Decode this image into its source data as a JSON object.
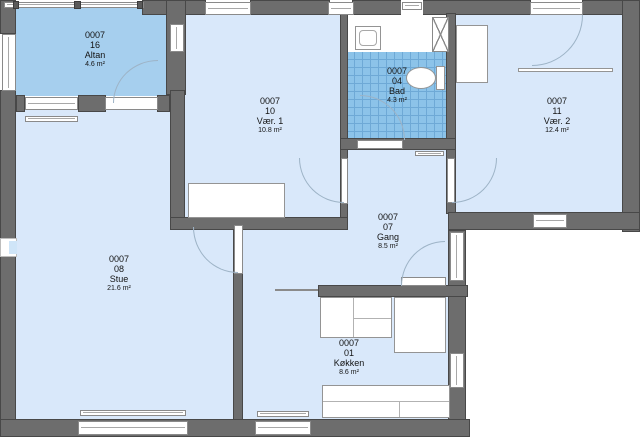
{
  "plan": {
    "type": "apartment-floor-plan",
    "unit_code": "0007",
    "rooms": {
      "altan": {
        "code": "0007",
        "number": "16",
        "name": "Altan",
        "area": "4.6 m²"
      },
      "vaer1": {
        "code": "0007",
        "number": "10",
        "name": "Vær. 1",
        "area": "10.8 m²"
      },
      "bad": {
        "code": "0007",
        "number": "04",
        "name": "Bad",
        "area": "4.3 m²"
      },
      "vaer2": {
        "code": "0007",
        "number": "11",
        "name": "Vær. 2",
        "area": "12.4 m²"
      },
      "gang": {
        "code": "0007",
        "number": "07",
        "name": "Gang",
        "area": "8.5 m²"
      },
      "stue": {
        "code": "0007",
        "number": "08",
        "name": "Stue",
        "area": "21.6 m²"
      },
      "koekken": {
        "code": "0007",
        "number": "01",
        "name": "Køkken",
        "area": "8.6 m²"
      }
    },
    "fixtures": [
      "toilet",
      "sink",
      "ventilation-shaft",
      "bed",
      "wardrobe",
      "shelf",
      "kitchen-counter",
      "kitchen-sink",
      "tall-cabinet",
      "radiator",
      "balcony-railing"
    ],
    "colors": {
      "wall": "#6d6d6d",
      "wall_outline": "#484848",
      "room_fill": "#d9e8fa",
      "balcony_fill": "#a6cfee",
      "bath_tile": "#8cc3e9",
      "bath_tile_line": "#6ea9d6",
      "door_arc": "#9db3c6",
      "outside": "#ffffff"
    }
  }
}
